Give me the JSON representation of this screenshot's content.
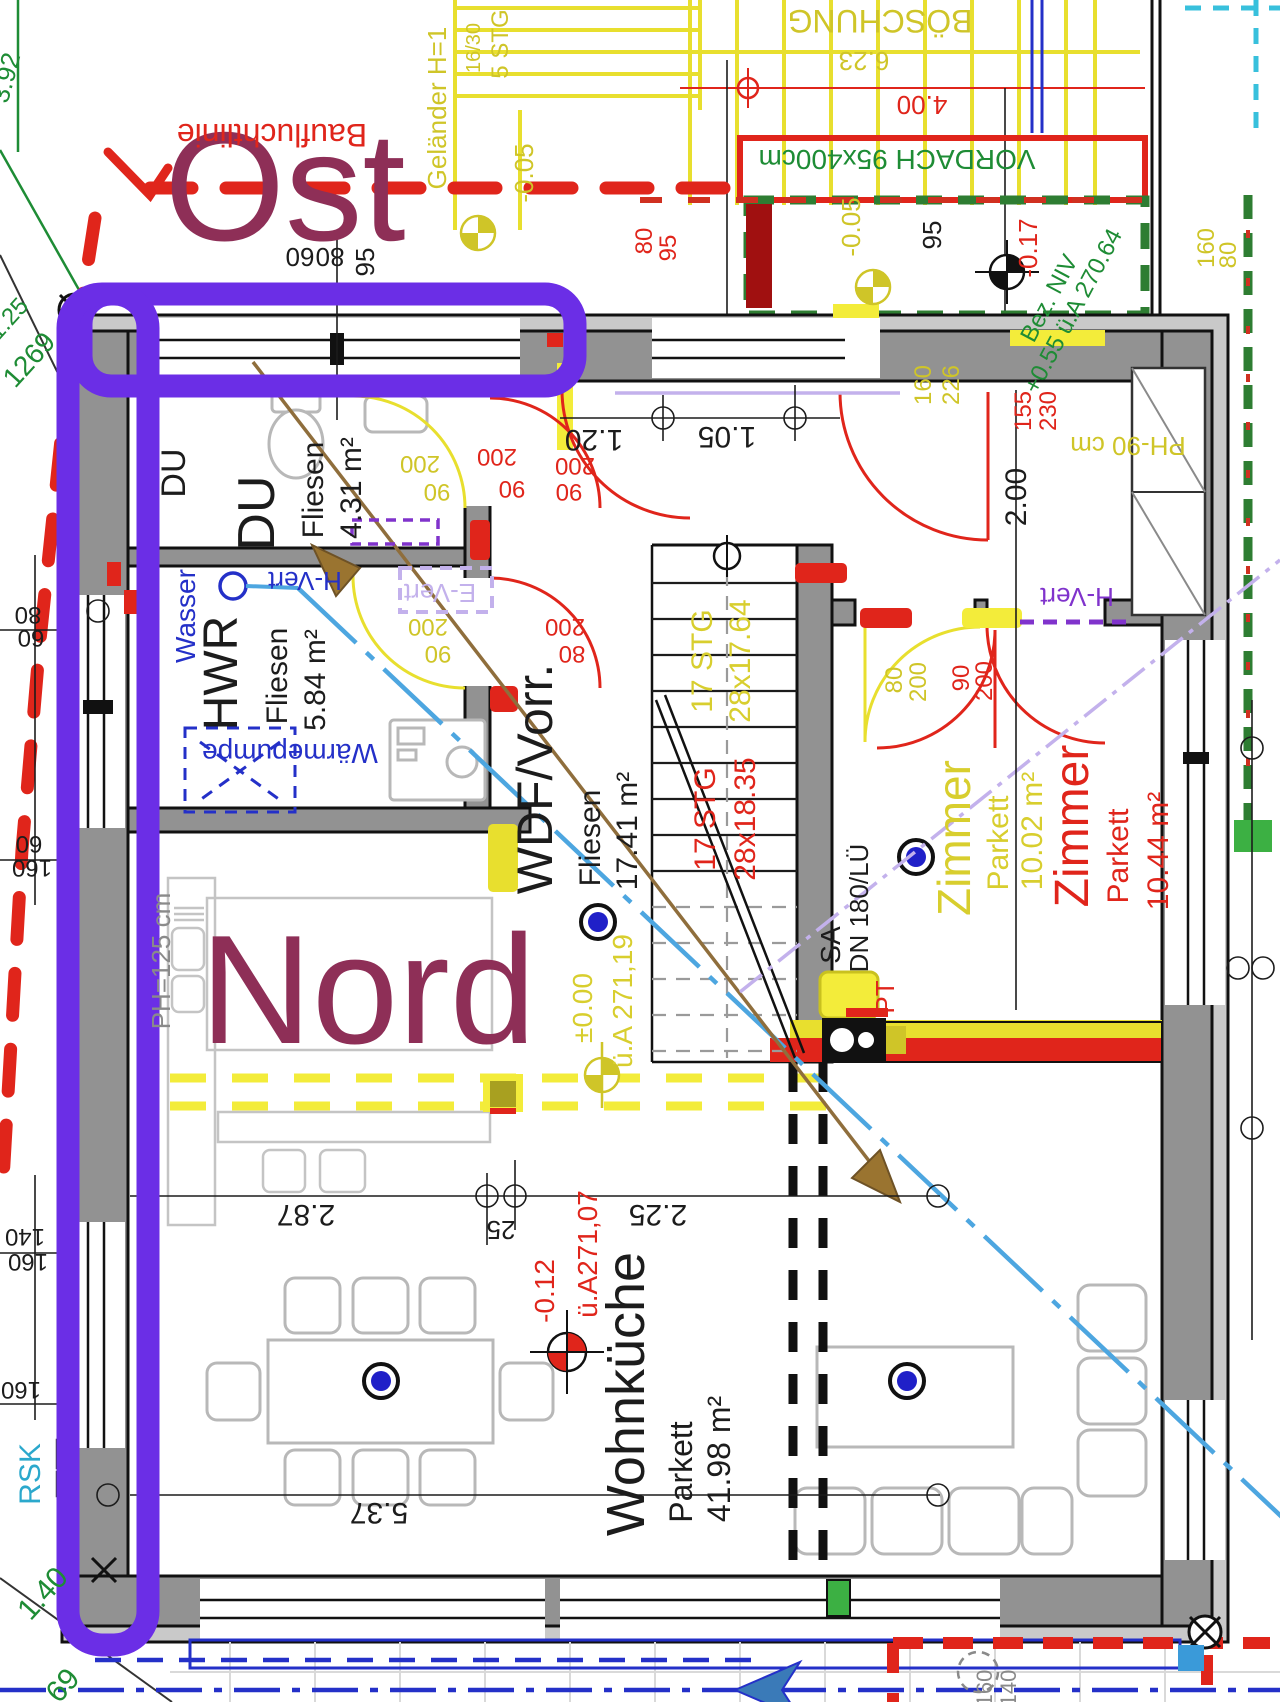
{
  "palette": {
    "highlight": "#6b2ee6",
    "compass_text": "#8e2f57",
    "plan_red": "#e0251b",
    "plan_yellow": "#e8df2e",
    "plan_green": "#1e8c35",
    "plan_blue": "#2430c8"
  },
  "compass": {
    "ost": "Ost",
    "nord": "Nord"
  },
  "site": {
    "baufluchtlinie": "Baufluchtlinie",
    "boeschung": "BÖSCHUNG",
    "d623": "6.23",
    "d400": "4.00",
    "vordach": "VORDACH 95x400cm",
    "gelaender": "Geländer H=1",
    "stg5": "5 STG",
    "stg1630": "16/30",
    "bezniv1": "Bez. NIV",
    "bezniv2": "+0.55 ü.A 270.64",
    "rsk": "RSK",
    "g392": "3.92",
    "g1269": "1269",
    "g125": "1.25",
    "g140": "1.40",
    "g69": "69"
  },
  "rooms": {
    "du_small": "DU",
    "du": {
      "name": "DU",
      "floor": "Fliesen",
      "area": "4.31 m²"
    },
    "hwr": {
      "name": "HWR",
      "floor": "Fliesen",
      "area": "5.84 m²"
    },
    "wdf": {
      "name": "WDF/Vorr.",
      "floor": "Fliesen",
      "area": "17.41 m²"
    },
    "zimmer_y": {
      "name": "Zimmer",
      "floor": "Parkett",
      "area": "10.02 m²"
    },
    "zimmer_r": {
      "name": "Zimmer",
      "floor": "Parkett",
      "area": "10.44 m²"
    },
    "kueche": {
      "name": "Wohnküche",
      "floor": "Parkett",
      "area": "41.98 m²"
    }
  },
  "tech": {
    "wasser": "Wasser",
    "waermepumpe": "Wärmepumpe",
    "hvert1": "H-Vert",
    "hvert2": "H-Vert",
    "evert": "E-Vert",
    "sa": "SA",
    "dn": "DN 180/LÜ",
    "pt": "PT",
    "ph125": "PH=125 cm",
    "ph90": "PH-90 cm"
  },
  "levels": {
    "p000": "±0.00",
    "ua19": "ü.A 271,19",
    "m012": "-0.12",
    "ua07": "ü.A271,07",
    "m005a": "-0.05",
    "m005b": "-0.05",
    "m017": "-0.17"
  },
  "stairs": {
    "y1": "17 STG",
    "y2": "28x17.64",
    "r1": "17 STG",
    "r2": "28x18.35"
  },
  "dims": {
    "d60": "60",
    "d80": "80",
    "d95a": "95",
    "d95b": "95",
    "d95c": "95",
    "d80r": "80",
    "d160y": "160",
    "d80y": "80",
    "d160w": "160",
    "d226": "226",
    "d155": "155",
    "d230": "230",
    "d200v": "2.00",
    "d105": "1.05",
    "d120": "1.20",
    "w200a": "200",
    "w90a": "90",
    "w200b": "200",
    "w90b": "90",
    "w200c": "200",
    "w90c": "90",
    "w200d": "200",
    "w90d": "90",
    "w200e": "200",
    "w80a": "80",
    "z80": "80",
    "z200a": "200",
    "z90": "90",
    "z200b": "200",
    "d287": "2.87",
    "d25": "25",
    "d225": "2.25",
    "d537": "5.37",
    "l80": "80",
    "l60a": "60",
    "l60b": "60",
    "l160a": "160",
    "l140": "140",
    "l160b": "160",
    "l160c": "160",
    "b160": "160",
    "b140": "140"
  }
}
